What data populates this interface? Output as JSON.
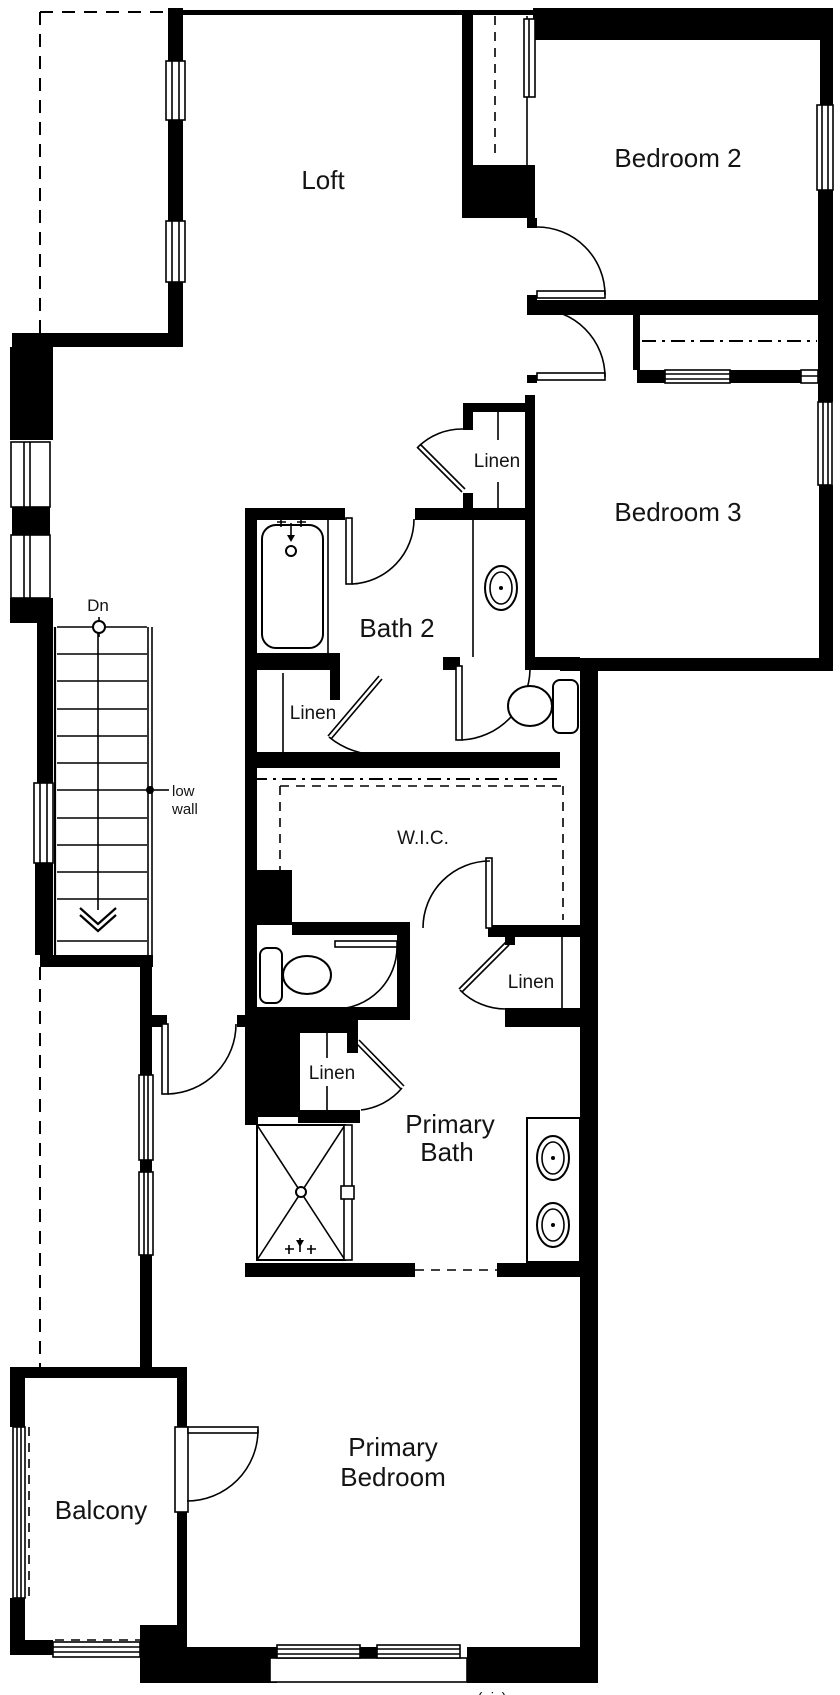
{
  "document": {
    "type": "floor-plan-drawing",
    "colors": {
      "walls": "#000000",
      "background": "#ffffff",
      "text": "#141414"
    }
  },
  "labels": {
    "loft": "Loft",
    "bedroom2": "Bedroom 2",
    "bedroom3": "Bedroom 3",
    "bath2": "Bath 2",
    "linen_top": "Linen",
    "linen_mid": "Linen",
    "linen_right": "Linen",
    "linen_lower": "Linen",
    "wic": "W.I.C.",
    "dn": "Dn",
    "low_wall_line1": "low",
    "low_wall_line2": "wall",
    "primary_bath_line1": "Primary",
    "primary_bath_line2": "Bath",
    "primary_bedroom_line1": "Primary",
    "primary_bedroom_line2": "Bedroom",
    "balcony": "Balcony",
    "partial_bottom_note": "(nic)"
  },
  "fixtures": [
    "bathtub",
    "tub-faucet",
    "bath2-sink",
    "bath2-toilet",
    "primary-toilet",
    "shower",
    "shower-faucet",
    "double-vanity-sink-1",
    "double-vanity-sink-2",
    "staircase-down",
    "stair-direction-arrow",
    "closet-rod-lines",
    "door-swings",
    "windows"
  ]
}
